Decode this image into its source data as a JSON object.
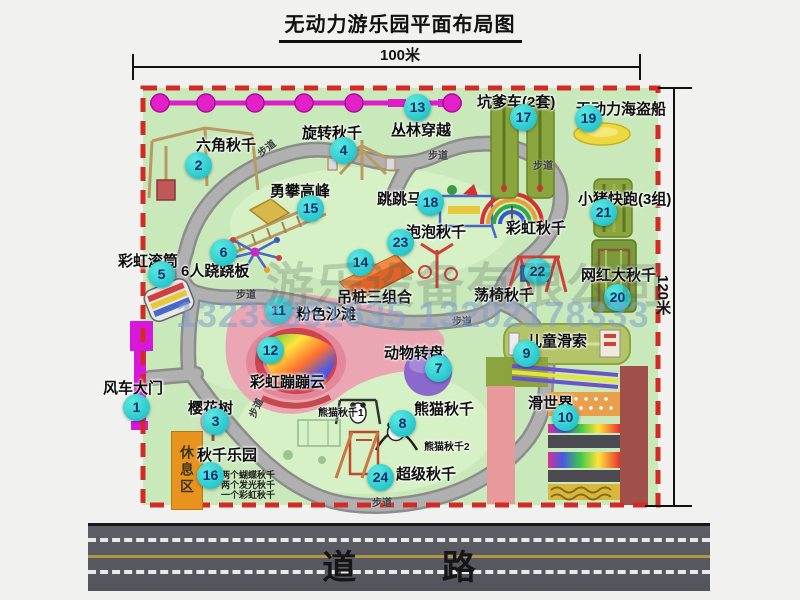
{
  "title": "无动力游乐园平面布局图",
  "dimensions": {
    "width_label": "100米",
    "height_label": "120米"
  },
  "road": {
    "label": "道 路"
  },
  "watermark": {
    "company": "游乐设备有限公司",
    "phone": "13233861635 13202178333"
  },
  "rest_area_label": "休息区",
  "colors": {
    "map_green": "#c9e9bb",
    "border_red": "#d32b24",
    "marker_cyan": "#17bfc8",
    "path_gray": "#aeaeae",
    "zipline_magenta": "#e01cc8",
    "road_gray": "#57575f",
    "rest_orange": "#e8931d"
  },
  "attractions": [
    {
      "n": "1",
      "name": "风车大门",
      "marker": [
        136,
        407
      ],
      "label": [
        103,
        377
      ]
    },
    {
      "n": "2",
      "name": "六角秋千",
      "marker": [
        198,
        165
      ],
      "label": [
        196,
        134
      ]
    },
    {
      "n": "3",
      "name": "樱花树",
      "marker": [
        215,
        421
      ],
      "label": [
        188,
        397
      ]
    },
    {
      "n": "4",
      "name": "旋转秋千",
      "marker": [
        343,
        150
      ],
      "label": [
        302,
        122
      ]
    },
    {
      "n": "5",
      "name": "彩虹滚筒",
      "marker": [
        161,
        274
      ],
      "label": [
        118,
        250
      ]
    },
    {
      "n": "6",
      "name": "6人跷跷板",
      "marker": [
        223,
        252
      ],
      "label": [
        181,
        260
      ]
    },
    {
      "n": "7",
      "name": "动物转盘",
      "marker": [
        438,
        368
      ],
      "label": [
        384,
        342
      ]
    },
    {
      "n": "8",
      "name": "熊猫秋千",
      "marker": [
        402,
        423
      ],
      "label": [
        414,
        398
      ]
    },
    {
      "n": "9",
      "name": "儿童滑索",
      "marker": [
        526,
        353
      ],
      "label": [
        527,
        330
      ]
    },
    {
      "n": "10",
      "name": "滑世界",
      "marker": [
        565,
        417
      ],
      "label": [
        528,
        392
      ]
    },
    {
      "n": "11",
      "name": "粉色沙滩",
      "marker": [
        278,
        310
      ],
      "label": [
        296,
        303
      ]
    },
    {
      "n": "12",
      "name": "彩虹蹦蹦云",
      "marker": [
        270,
        350
      ],
      "label": [
        250,
        371
      ]
    },
    {
      "n": "13",
      "name": "丛林穿越",
      "marker": [
        417,
        107
      ],
      "label": [
        391,
        119
      ]
    },
    {
      "n": "14",
      "name": "吊桩三组合",
      "marker": [
        360,
        262
      ],
      "label": [
        337,
        286
      ]
    },
    {
      "n": "15",
      "name": "勇攀高峰",
      "marker": [
        310,
        208
      ],
      "label": [
        270,
        180
      ]
    },
    {
      "n": "16",
      "name": "秋千乐园",
      "marker": [
        210,
        475
      ],
      "label": [
        197,
        444
      ]
    },
    {
      "n": "17",
      "name": "坑爹车(2套)",
      "marker": [
        523,
        117
      ],
      "label": [
        477,
        91
      ]
    },
    {
      "n": "18",
      "name": "跳跳马",
      "marker": [
        430,
        202
      ],
      "label": [
        377,
        188
      ]
    },
    {
      "n": "19",
      "name": "无动力海盗船",
      "marker": [
        588,
        118
      ],
      "label": [
        576,
        98
      ]
    },
    {
      "n": "20",
      "name": "网红大秋千",
      "marker": [
        617,
        297
      ],
      "label": [
        581,
        264
      ]
    },
    {
      "n": "21",
      "name": "小猪快跑(3组)",
      "marker": [
        603,
        212
      ],
      "label": [
        578,
        188
      ]
    },
    {
      "n": "22",
      "name": "荡椅秋千",
      "marker": [
        537,
        271
      ],
      "label": [
        474,
        284
      ]
    },
    {
      "n": "23",
      "name": "泡泡秋千",
      "marker": [
        400,
        242
      ],
      "label": [
        406,
        221
      ]
    },
    {
      "n": "24",
      "name": "超级秋千",
      "marker": [
        380,
        477
      ],
      "label": [
        396,
        463
      ]
    }
  ],
  "sub_labels": [
    {
      "text": "彩虹秋千",
      "pos": [
        506,
        217
      ],
      "size": 15
    },
    {
      "text": "熊猫秋千1",
      "pos": [
        318,
        404
      ],
      "size": 10
    },
    {
      "text": "熊猫秋千2",
      "pos": [
        424,
        438
      ],
      "size": 10
    }
  ],
  "swing_notes": [
    "两个蝴蝶秋千",
    "两个发光秋千",
    "一个彩虹秋千"
  ],
  "walkway_labels": {
    "text": "步道",
    "positions": [
      [
        256,
        140,
        -38
      ],
      [
        428,
        147,
        0
      ],
      [
        533,
        157,
        0
      ],
      [
        236,
        286,
        0
      ],
      [
        452,
        313,
        0
      ],
      [
        245,
        400,
        -65
      ],
      [
        372,
        494,
        0
      ]
    ]
  },
  "icons": [
    "windmill-gate-icon",
    "zipline-icon",
    "hex-swing-icon",
    "rotary-swing-icon",
    "climbing-bridge-icon",
    "rainbow-roller-icon",
    "seesaw-spinner-icon",
    "pink-beach",
    "rainbow-cloud",
    "bubble-swing-icon",
    "hanging-post-icon",
    "jumping-horse-icon",
    "rainbow-swing-icon",
    "pirate-ship-icon",
    "pit-cart-track-icon",
    "pig-run-track-icon",
    "big-swing-icon",
    "kids-zipline-icon",
    "chair-swing-icon",
    "animal-carousel-icon",
    "panda-swing-icon",
    "super-swing-icon",
    "slide-world",
    "sakura-tree-icon",
    "swing-park-sketch"
  ]
}
